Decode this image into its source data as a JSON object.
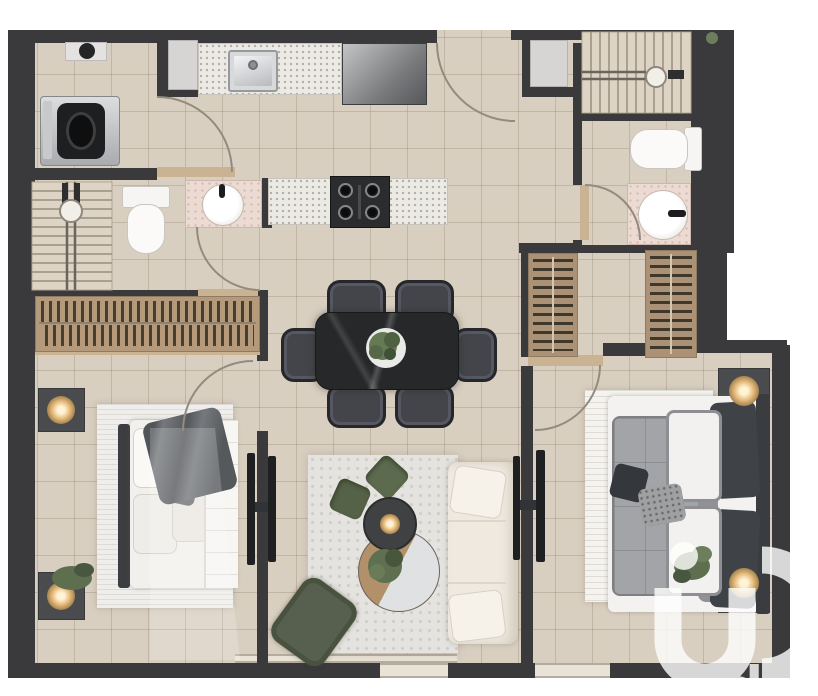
{
  "watermark": {
    "brand": "iad"
  },
  "palette": {
    "wall": "#3a3a3c",
    "floor_tile": "#d9cfc1",
    "granite_counter": "#eceae5",
    "pink_marble": "#ecdbd3",
    "closet_wood": "#b49a7b",
    "sofa_cream": "#efe9e0",
    "cushion_green": "#5c6a4e",
    "lamp_gold": "#edc488",
    "dining_table_black": "#27282a",
    "duvet_gray": "#a3a4a7"
  },
  "fixtures": [
    "washing-machine",
    "water-heater",
    "kitchen-sink",
    "refrigerator",
    "gas-stove",
    "bathroom-basin",
    "toilet",
    "staircase",
    "wardrobe-closet",
    "dining-table",
    "dining-chair",
    "plant",
    "sofa",
    "coffee-table",
    "armchair",
    "tv",
    "double-bed",
    "nightstand",
    "lamp",
    "rug",
    "door-swing",
    "window"
  ],
  "rooms_visible": [
    "laundry",
    "kitchen",
    "bathroom-left",
    "bathroom-right",
    "entry-hall",
    "dining",
    "living",
    "bedroom-left",
    "bedroom-right",
    "dressing-hall"
  ]
}
